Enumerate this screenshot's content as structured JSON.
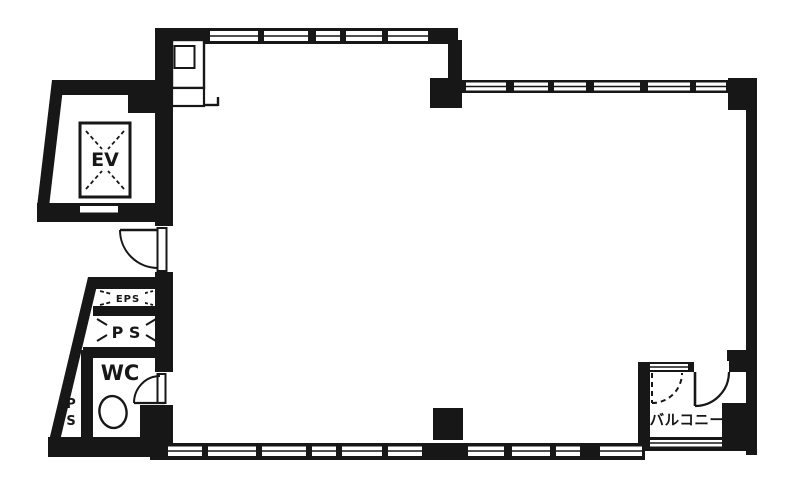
{
  "floorplan": {
    "type": "building-floor-plan",
    "rooms": {
      "elevator": {
        "label": "EV"
      },
      "eps_shaft": {
        "label": "EPS"
      },
      "pipe_space": {
        "label": "P S"
      },
      "toilet": {
        "label": "WC"
      },
      "pipe_shaft_vertical": {
        "line1": "P",
        "line2": "S"
      },
      "balcony": {
        "label": "バルコニー"
      },
      "main_room": {
        "label": ""
      }
    },
    "colors": {
      "ink": "#171717",
      "paper": "#ffffff"
    }
  }
}
